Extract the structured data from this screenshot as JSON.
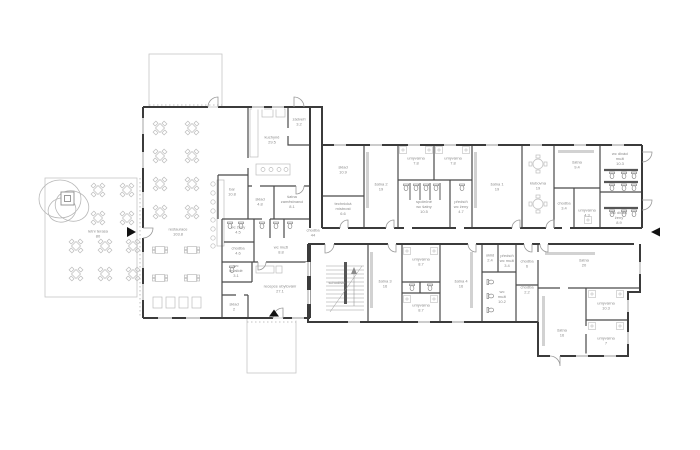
{
  "drawing": {
    "type": "architectural floor plan (ground floor) – restaurant with accommodation reception and changing-room wing",
    "colors": {
      "background": "#ffffff",
      "wall": "#3b3b3b",
      "partition": "#4a4a4a",
      "furniture": "#bdbdbd",
      "light_outline": "#c6c6c6",
      "label_text": "#8a8a8a",
      "entrance_marker": "#111111"
    }
  },
  "rooms": [
    {
      "label": "letní terasa\n80"
    },
    {
      "label": "restaurace\n103.8"
    },
    {
      "label": "bar\n10.8"
    },
    {
      "label": "kuchyně\n29.5"
    },
    {
      "label": "zádveří\n3.2"
    },
    {
      "label": "sklad\n4.8"
    },
    {
      "label": "šatna\nzaměstnanci\n8.1"
    },
    {
      "label": "wc ženy\n4.5"
    },
    {
      "label": "chodba\n4.6"
    },
    {
      "label": "wc muži\n8.8"
    },
    {
      "label": "wc\ninvalidé\n3.1"
    },
    {
      "label": "recepce ubytování\n27.1"
    },
    {
      "label": "sklad\n2"
    },
    {
      "label": "chodba\n44"
    },
    {
      "label": "sklad\n10.9"
    },
    {
      "label": "technická\nmístnost\n6.6"
    },
    {
      "label": "šatna 2\n19"
    },
    {
      "label": "umývárna\n7.8"
    },
    {
      "label": "umývárna\n7.8"
    },
    {
      "label": "společné\nwc šatny\n10.5"
    },
    {
      "label": "předsíň\nwc ženy\n4.7"
    },
    {
      "label": "šatna 1\n19"
    },
    {
      "label": "klubovna\n19"
    },
    {
      "label": "šatna\n9.4"
    },
    {
      "label": "chodba\n3.4"
    },
    {
      "label": "umývárna\n4.3"
    },
    {
      "label": "wc diváci\nmuži\n10.3"
    },
    {
      "label": "wc diváci\nženy\n8.9"
    },
    {
      "label": "schodiště"
    },
    {
      "label": "šatna 3\n16"
    },
    {
      "label": "umývárna\n8.7"
    },
    {
      "label": "umývárna\n8.7"
    },
    {
      "label": "šatna 4\n16"
    },
    {
      "label": "úklid\n2.4"
    },
    {
      "label": "předsíň\nwc muži\n3.4"
    },
    {
      "label": "wc\nmuži\n10.2"
    },
    {
      "label": "chodba\n6"
    },
    {
      "label": "chodba\n2.2"
    },
    {
      "label": "šatna\n20"
    },
    {
      "label": "umývárna\n10.3"
    },
    {
      "label": "šatna\n16"
    },
    {
      "label": "umývárna\n7"
    }
  ]
}
